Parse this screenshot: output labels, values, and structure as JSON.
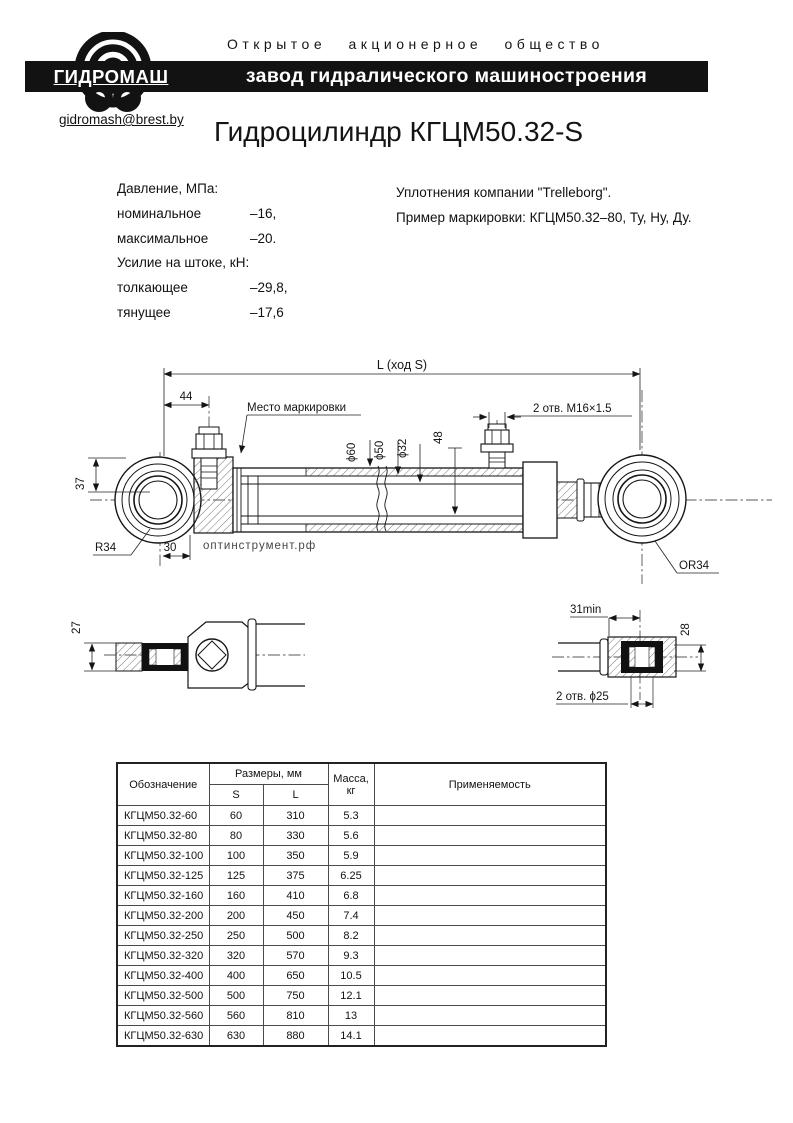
{
  "header": {
    "society_line": "Открытое акционерное общество",
    "bar_title": "завод гидралического машиностроения",
    "logo_text": "ГИДРОМАШ",
    "email": "gidromash@brest.by"
  },
  "title": "Гидроцилиндр КГЦМ50.32-S",
  "specs": {
    "left": [
      {
        "label": "Давление, МПа:",
        "value": ""
      },
      {
        "label": "номинальное",
        "value": "–16,"
      },
      {
        "label": "максимальное",
        "value": "–20."
      },
      {
        "label": "Усилие на штоке, кН:",
        "value": ""
      },
      {
        "label": "толкающее",
        "value": "–29,8,"
      },
      {
        "label": "тянущее",
        "value": "–17,6"
      }
    ],
    "right": [
      "Уплотнения компании \"Trelleborg\".",
      "Пример маркировки: КГЦМ50.32–80, Ту, Ну, Ду."
    ]
  },
  "drawing": {
    "dim_total_length": "L (ход S)",
    "dim_44": "44",
    "dim_37": "37",
    "dim_30": "30",
    "dim_48": "48",
    "label_marking_spot": "Место маркировки",
    "label_ports": "2 отв. М16×1.5",
    "dia_60": "ϕ60",
    "dia_50": "ϕ50",
    "dia_32": "ϕ32",
    "label_r34": "R34",
    "label_or34": "OR34",
    "detail_left_dim_27": "27",
    "detail_right_dim_31": "31min",
    "detail_right_dim_28": "28",
    "detail_right_holes": "2 отв. ϕ25",
    "watermark": "оптинструмент.рф",
    "watermark_color": "#c8cfeb"
  },
  "table": {
    "headers": {
      "designation": "Обозначение",
      "sizes_group": "Размеры, мм",
      "col_s": "S",
      "col_l": "L",
      "mass_line1": "Масса,",
      "mass_line2": "кг",
      "application": "Применяемость"
    },
    "rows": [
      {
        "d": "КГЦМ50.32-60",
        "s": "60",
        "l": "310",
        "m": "5.3",
        "app": ""
      },
      {
        "d": "КГЦМ50.32-80",
        "s": "80",
        "l": "330",
        "m": "5.6",
        "app": ""
      },
      {
        "d": "КГЦМ50.32-100",
        "s": "100",
        "l": "350",
        "m": "5.9",
        "app": ""
      },
      {
        "d": "КГЦМ50.32-125",
        "s": "125",
        "l": "375",
        "m": "6.25",
        "app": ""
      },
      {
        "d": "КГЦМ50.32-160",
        "s": "160",
        "l": "410",
        "m": "6.8",
        "app": ""
      },
      {
        "d": "КГЦМ50.32-200",
        "s": "200",
        "l": "450",
        "m": "7.4",
        "app": ""
      },
      {
        "d": "КГЦМ50.32-250",
        "s": "250",
        "l": "500",
        "m": "8.2",
        "app": ""
      },
      {
        "d": "КГЦМ50.32-320",
        "s": "320",
        "l": "570",
        "m": "9.3",
        "app": ""
      },
      {
        "d": "КГЦМ50.32-400",
        "s": "400",
        "l": "650",
        "m": "10.5",
        "app": ""
      },
      {
        "d": "КГЦМ50.32-500",
        "s": "500",
        "l": "750",
        "m": "12.1",
        "app": ""
      },
      {
        "d": "КГЦМ50.32-560",
        "s": "560",
        "l": "810",
        "m": "13",
        "app": ""
      },
      {
        "d": "КГЦМ50.32-630",
        "s": "630",
        "l": "880",
        "m": "14.1",
        "app": ""
      }
    ]
  }
}
